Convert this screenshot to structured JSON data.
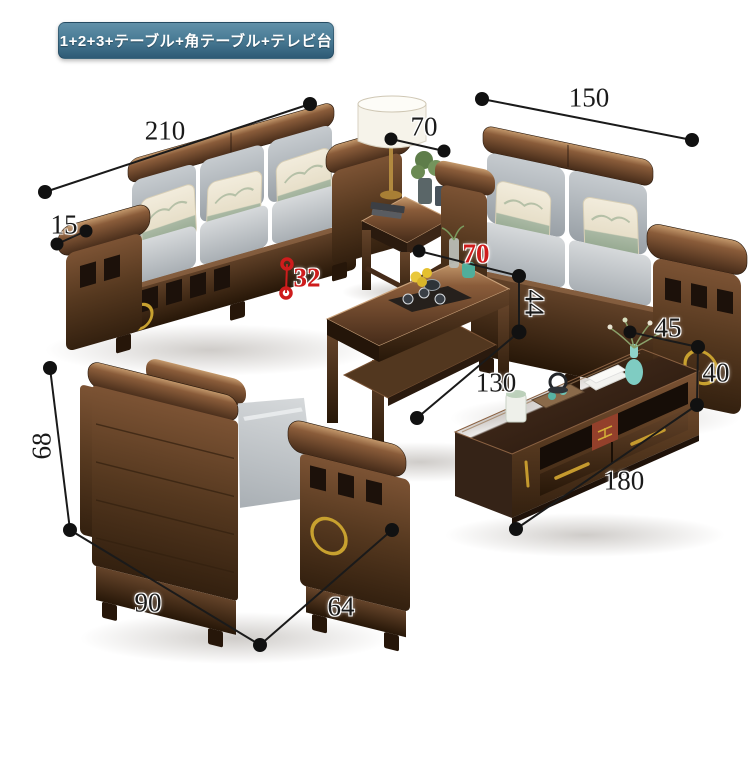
{
  "header": {
    "badge_label": "1+2+3+テーブル+角テーブル+テレビ台"
  },
  "palette": {
    "background": "#ffffff",
    "badge_gradient_top": "#6190a8",
    "badge_gradient_bottom": "#2e5a75",
    "badge_text": "#ffffff",
    "dimension_line": "#1a1a1a",
    "dimension_text": "#1a1a1a",
    "dimension_accent_red": "#ce1c1c",
    "wood_dark": "#2f1f14",
    "wood_mid": "#5b3b27",
    "wood_highlight": "#c59a6d",
    "cushion_gray": "#b7bcc1",
    "pillow_cream": "#efe8d8",
    "pillow_green_band": "#a9b8a3",
    "gold_accent": "#c8a12f",
    "lamp_shade": "#f6f3ea",
    "vase_teal": "#7fccc2"
  },
  "dimensions": [
    {
      "value": "210",
      "measures": "three-seater-width",
      "color": "black",
      "rotation": "none"
    },
    {
      "value": "15",
      "measures": "three-seater-armrest-width",
      "color": "black",
      "rotation": "none"
    },
    {
      "value": "70",
      "measures": "side-table-width",
      "color": "black",
      "rotation": "none"
    },
    {
      "value": "150",
      "measures": "two-seater-width",
      "color": "black",
      "rotation": "none"
    },
    {
      "value": "32",
      "measures": "seat-height",
      "color": "red",
      "rotation": "none"
    },
    {
      "value": "70",
      "measures": "coffee-table-depth",
      "color": "red",
      "rotation": "none"
    },
    {
      "value": "44",
      "measures": "coffee-table-height",
      "color": "black",
      "rotation": "cw90"
    },
    {
      "value": "130",
      "measures": "coffee-table-length",
      "color": "black",
      "rotation": "none"
    },
    {
      "value": "45",
      "measures": "tv-stand-depth",
      "color": "black",
      "rotation": "none"
    },
    {
      "value": "40",
      "measures": "tv-stand-height",
      "color": "black",
      "rotation": "none"
    },
    {
      "value": "180",
      "measures": "tv-stand-length",
      "color": "black",
      "rotation": "none"
    },
    {
      "value": "68",
      "measures": "armchair-height",
      "color": "black",
      "rotation": "ccw90"
    },
    {
      "value": "90",
      "measures": "armchair-width",
      "color": "black",
      "rotation": "none"
    },
    {
      "value": "64",
      "measures": "armchair-depth",
      "color": "black",
      "rotation": "none"
    }
  ]
}
